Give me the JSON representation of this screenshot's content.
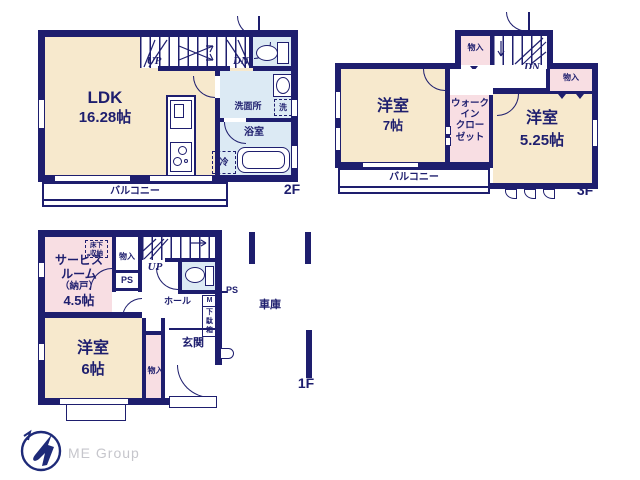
{
  "colors": {
    "wall_navy": "#1e1e6e",
    "room_cream": "#f7e9cd",
    "room_pink": "#f8dee3",
    "room_blue": "#dceaf4",
    "logo_gray": "#c6c6cc"
  },
  "floor2": {
    "label": "2F",
    "ldk_name": "LDK",
    "ldk_size": "16.28帖",
    "up": "UP",
    "down": "DN",
    "washroom": "洗面所",
    "laundry": "洗",
    "bath": "浴室",
    "fridge": "冷",
    "balcony": "バルコニー"
  },
  "floor3": {
    "label": "3F",
    "down": "DN",
    "storage_left": "物入",
    "storage_right": "物入",
    "room_left_name": "洋室",
    "room_left_size": "7帖",
    "wic": "ウォーク\nイン\nクロー\nゼット",
    "room_right_name": "洋室",
    "room_right_size": "5.25帖",
    "balcony": "バルコニー"
  },
  "floor1": {
    "label": "1F",
    "up": "UP",
    "service_l1": "サービス",
    "service_l2": "ルーム",
    "service_l3": "（納戸）",
    "service_l4": "4.5帖",
    "underfloor": "床下\n収納",
    "storage_top": "物入",
    "ps_top": "PS",
    "ps_right": "PS",
    "hall": "ホール",
    "shoe_m": "M",
    "shoe_box": "下\n駄\n箱",
    "entrance": "玄関",
    "room_name": "洋室",
    "room_size": "6帖",
    "storage_bottom": "物入",
    "garage": "車庫"
  },
  "logo": {
    "text": "ME Group"
  }
}
